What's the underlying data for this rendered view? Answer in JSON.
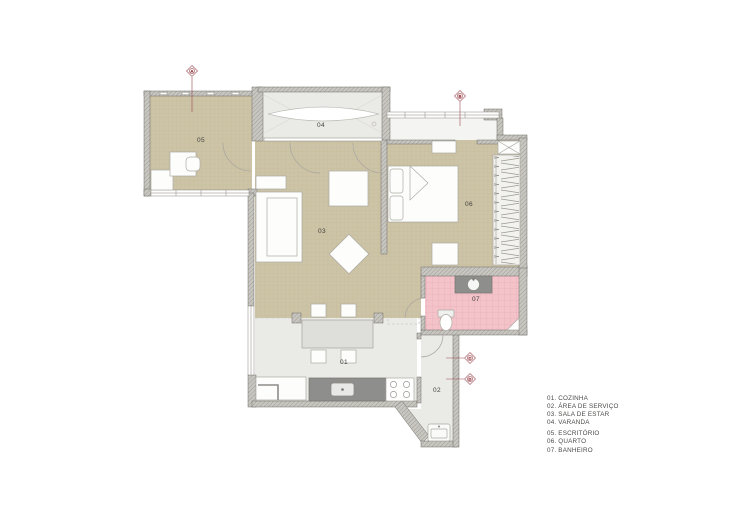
{
  "plan": {
    "type": "apartment-floor-plan",
    "rooms": [
      {
        "num": "01",
        "name": "COZINHA"
      },
      {
        "num": "02",
        "name": "ÁREA DE SERVIÇO"
      },
      {
        "num": "03",
        "name": "SALA DE ESTAR"
      },
      {
        "num": "04",
        "name": "VARANDA"
      },
      {
        "num": "05",
        "name": "ESCRITÓRIO"
      },
      {
        "num": "06",
        "name": "QUARTO"
      },
      {
        "num": "07",
        "name": "BANHEIRO"
      }
    ]
  },
  "legend": {
    "items": [
      "01. COZINHA",
      "02. ÁREA DE SERVIÇO",
      "03. SALA DE ESTAR",
      "04. VARANDA",
      "05. ESCRITÓRIO",
      "06. QUARTO",
      "07. BANHEIRO"
    ]
  },
  "markers": [
    {
      "letter": "A"
    },
    {
      "letter": "B"
    },
    {
      "letter": "C"
    },
    {
      "letter": "D"
    }
  ],
  "colors": {
    "floor_tan": "#CDC3A6",
    "tan_grid": "#C2B795",
    "floor_gray": "#EAEAE7",
    "floor_entry": "#F4F4F2",
    "floor_pink": "#F4C3CA",
    "pink_grid": "#E2A8B2",
    "wall_fill": "#C8C6C0",
    "wall_hatch": "#99978F",
    "wall_edge": "#6F6D66",
    "counter_dark": "#8E8E8C",
    "furniture_fill": "#FDFDFC",
    "furniture_stroke": "#ACAAA3",
    "marker": "#9C4A52",
    "label_text": "#3F3F3D"
  }
}
